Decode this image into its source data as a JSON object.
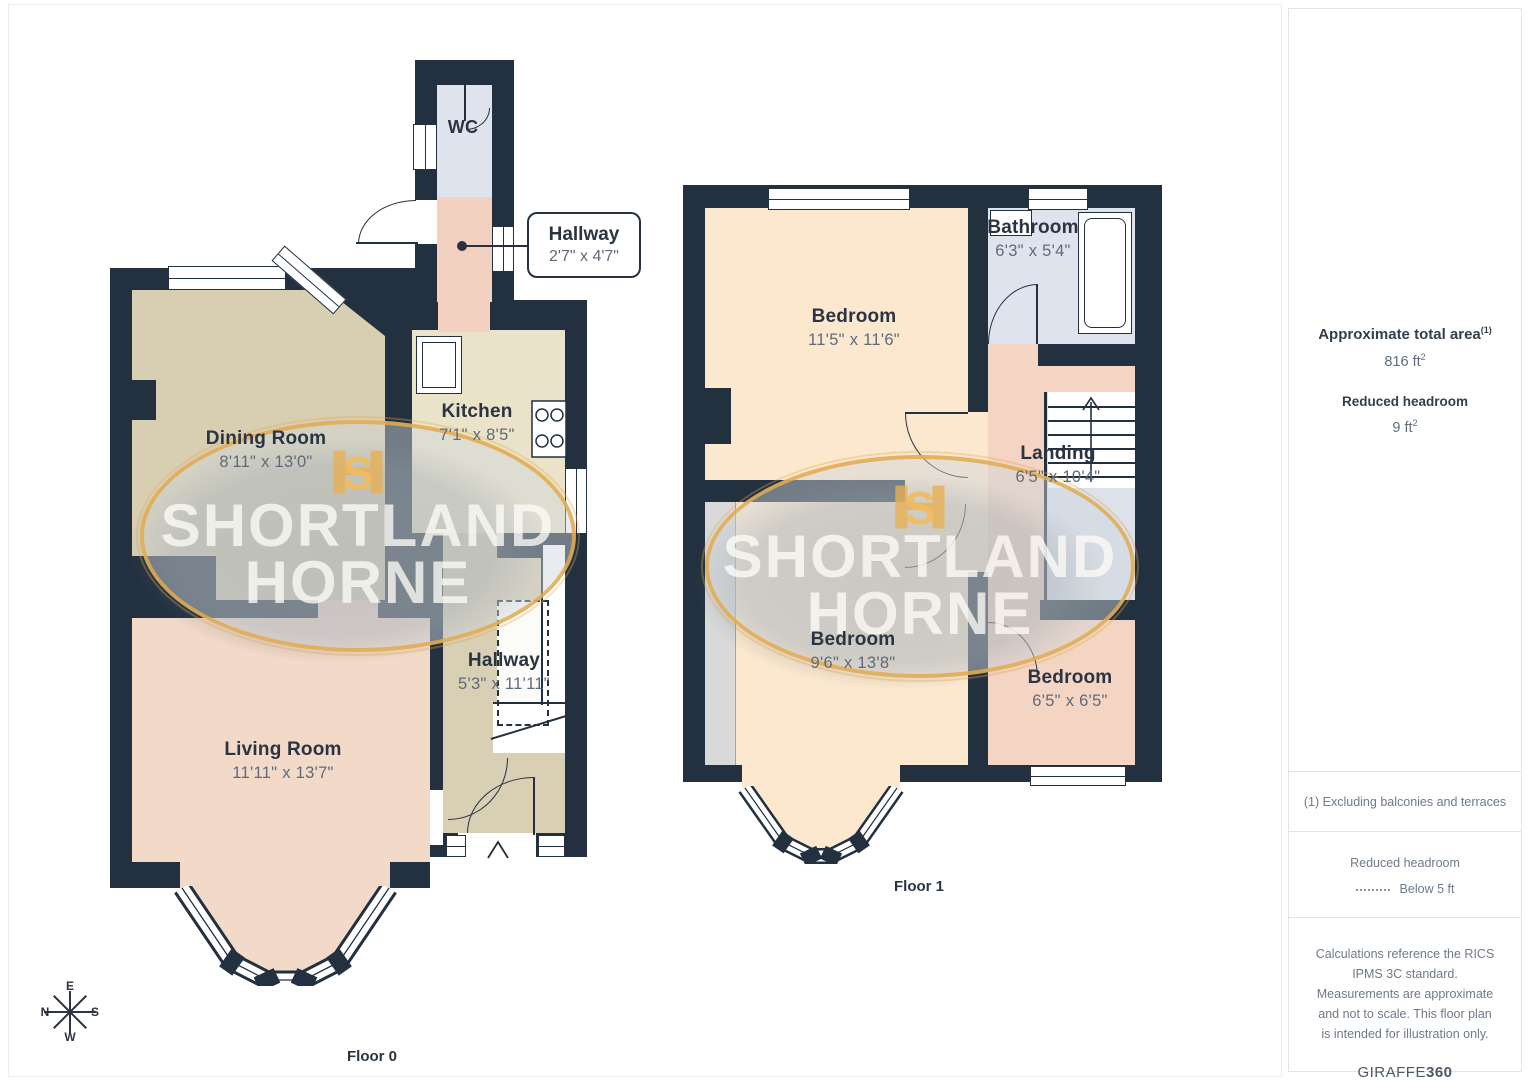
{
  "floor0": {
    "label": "Floor 0",
    "wc": {
      "name": "WC"
    },
    "entry_hallway": {
      "name": "Hallway",
      "dims": "2'7\" x 4'7\""
    },
    "kitchen": {
      "name": "Kitchen",
      "dims": "7'1\" x 8'5\""
    },
    "dining_room": {
      "name": "Dining Room",
      "dims": "8'11\" x 13'0\""
    },
    "living_room": {
      "name": "Living Room",
      "dims": "11'11\" x 13'7\""
    },
    "hallway": {
      "name": "Hallway",
      "dims": "5'3\" x 11'11\""
    }
  },
  "floor1": {
    "label": "Floor 1",
    "bedroom_front": {
      "name": "Bedroom",
      "dims": "11'5\" x 11'6\""
    },
    "bathroom": {
      "name": "Bathroom",
      "dims": "6'3\" x 5'4\""
    },
    "landing": {
      "name": "Landing",
      "dims": "6'5\" x 10'4\""
    },
    "bedroom_rear": {
      "name": "Bedroom",
      "dims": "9'6\" x 13'8\""
    },
    "bedroom_small": {
      "name": "Bedroom",
      "dims": "6'5\" x 6'5\""
    }
  },
  "compass": {
    "n": "N",
    "e": "E",
    "s": "S",
    "w": "W"
  },
  "watermark": {
    "line1": "SHORTLAND",
    "line2": "HORNE",
    "monogram_h": "H",
    "monogram_s": "S"
  },
  "sidebar": {
    "total_area_label": "Approximate total area",
    "total_area_sup": "(1)",
    "total_area_value": "816 ft",
    "sq_sup": "2",
    "headroom_label": "Reduced headroom",
    "headroom_value": "9 ft",
    "note": "(1) Excluding balconies and terraces",
    "legend_title": "Reduced headroom",
    "legend_label": "Below 5 ft",
    "disclaimer": "Calculations reference the RICS IPMS 3C standard. Measurements are approximate and not to scale. This floor plan is intended for illustration only.",
    "brand_name": "GIRAFFE",
    "brand_suffix": "360"
  },
  "colors": {
    "wall": "#22303f",
    "accent_gold": "#e8b45c",
    "living": "#f2d9c8",
    "dining": "#d8cfb2",
    "kitchen": "#ebe3c9",
    "bath": "#dfe3ee",
    "bedroom": "#fce8cf",
    "landing": "#f4d4c2"
  }
}
